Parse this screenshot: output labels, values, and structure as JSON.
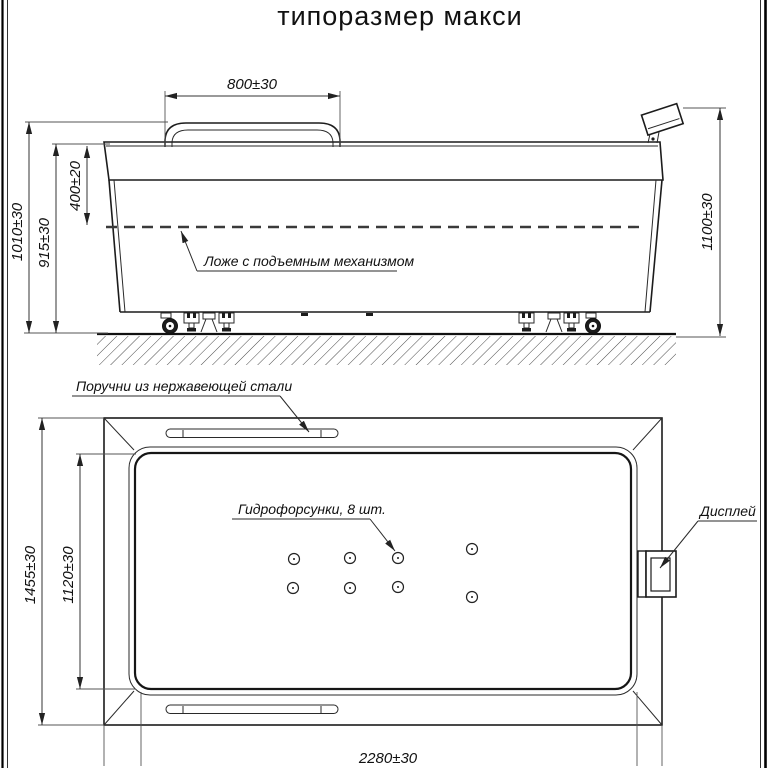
{
  "title": "типоразмер макси",
  "side_view": {
    "dim_handrail": "800±30",
    "dim_height_overall": "1010±30",
    "dim_height_rim": "915±30",
    "dim_depth": "400±20",
    "dim_height_display": "1100±30",
    "label_bed": "Ложе с подъемным механизмом"
  },
  "top_view": {
    "label_handrails": "Поручни из нержавеющей стали",
    "label_jets": "Гидрофорсунки, 8 шт.",
    "label_display": "Дисплей",
    "dim_width_overall": "1455±30",
    "dim_width_inner": "1120±30",
    "dim_length": "2280±30",
    "jets_count": 8
  },
  "colors": {
    "line": "#1c1c1c",
    "background": "#ffffff"
  }
}
